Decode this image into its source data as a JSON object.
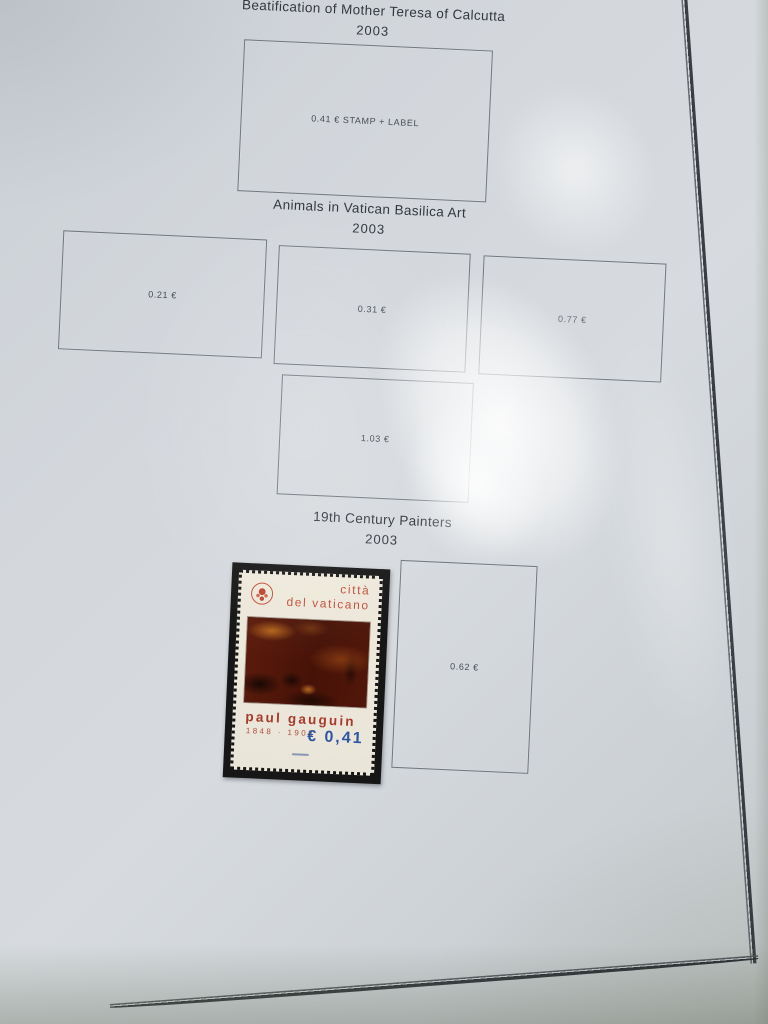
{
  "page_type": "stamp album page photographed in protective sleeve",
  "sections": [
    {
      "title": "Beatification of Mother Teresa of Calcutta",
      "year": "2003",
      "boxes": [
        {
          "label": "0.41 € STAMP + LABEL"
        }
      ]
    },
    {
      "title": "Animals in Vatican Basilica Art",
      "year": "2003",
      "boxes": [
        {
          "label": "0.21 €"
        },
        {
          "label": "0.31 €"
        },
        {
          "label": "0.77 €"
        },
        {
          "label": "1.03 €"
        }
      ]
    },
    {
      "title": "19th Century Painters",
      "year": "2003",
      "boxes": [
        {
          "label": "0.62 €"
        }
      ]
    }
  ],
  "stamp": {
    "country_line1": "città",
    "country_line2": "del vaticano",
    "artist": "paul gauguin",
    "years": "1848 · 1903",
    "denomination": "€ 0,41",
    "subject": "dark red Gauguin painting",
    "colors": {
      "text_red": "#c24f3d",
      "denomination_blue": "#2f55a4",
      "paper_cream": "#ece7d9",
      "mount_black": "#161616"
    }
  },
  "page_colors": {
    "paper": "#d3d7dc",
    "border_line": "#2c3036",
    "box_outline": "#70777f",
    "title_text": "#33383e"
  }
}
